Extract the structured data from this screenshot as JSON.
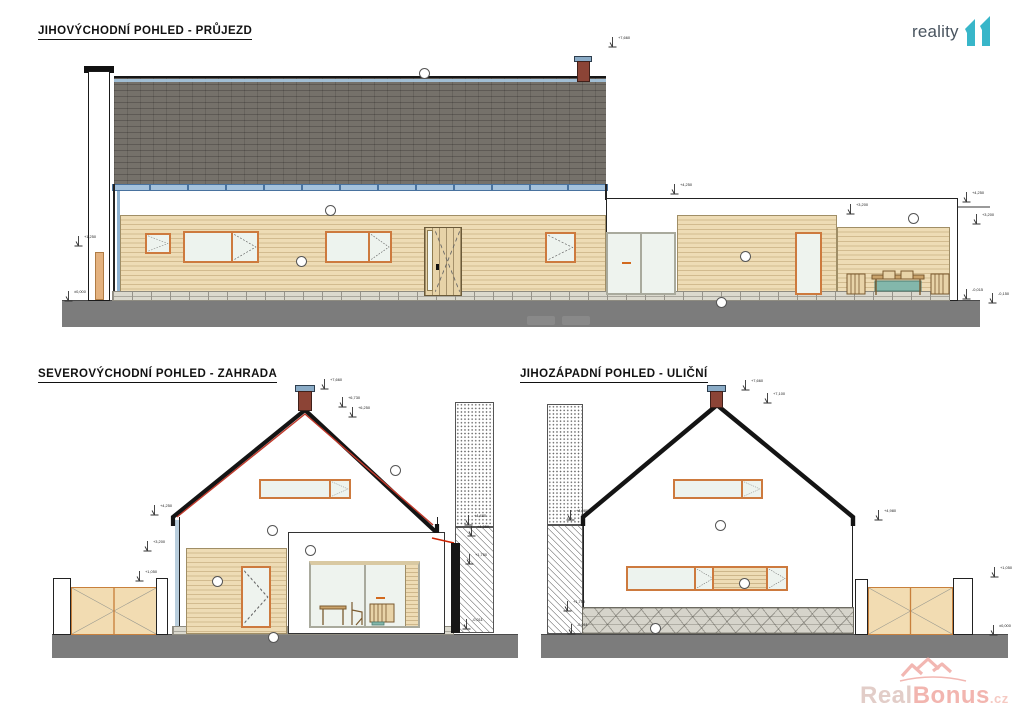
{
  "titles": {
    "southeast": "JIHOVÝCHODNÍ POHLED - PRŮJEZD",
    "northeast": "SEVEROVÝCHODNÍ POHLED - ZAHRADA",
    "southwest": "JIHOZÁPADNÍ POHLED - ULIČNÍ"
  },
  "logo": {
    "word": "reality",
    "number": "11",
    "color": "#38b6c9"
  },
  "watermark": {
    "real": "Real",
    "bonus": "Bonus",
    "tld": ".cz"
  },
  "colors": {
    "roof": "#75716a",
    "gutter": "#a3c1dc",
    "siding": "#eedcb5",
    "window_frame": "#cd7a3e",
    "ground": "#7c7c7c",
    "gate": "#f2dcb2",
    "roof_edge_accent": "#c0392b"
  },
  "level_markers": [
    {
      "x": 608,
      "y": 36,
      "label": "+7,660"
    },
    {
      "x": 670,
      "y": 183,
      "label": "+4,250"
    },
    {
      "x": 846,
      "y": 203,
      "label": "+3,200"
    },
    {
      "x": 962,
      "y": 191,
      "label": "+4,250"
    },
    {
      "x": 972,
      "y": 213,
      "label": "+3,200"
    },
    {
      "x": 74,
      "y": 235,
      "label": "+1,250"
    },
    {
      "x": 64,
      "y": 290,
      "label": "±0,000"
    },
    {
      "x": 962,
      "y": 288,
      "label": "-0,015"
    },
    {
      "x": 988,
      "y": 292,
      "label": "-0,150"
    },
    {
      "x": 320,
      "y": 378,
      "label": "+7,660"
    },
    {
      "x": 338,
      "y": 396,
      "label": "+6,730"
    },
    {
      "x": 348,
      "y": 406,
      "label": "+6,250"
    },
    {
      "x": 150,
      "y": 504,
      "label": "+4,250"
    },
    {
      "x": 143,
      "y": 540,
      "label": "+3,200"
    },
    {
      "x": 135,
      "y": 570,
      "label": "+1,050"
    },
    {
      "x": 464,
      "y": 514,
      "label": "+4,480"
    },
    {
      "x": 467,
      "y": 525,
      "label": "+4,250"
    },
    {
      "x": 465,
      "y": 553,
      "label": "+1,750"
    },
    {
      "x": 462,
      "y": 618,
      "label": "-0,011"
    },
    {
      "x": 741,
      "y": 379,
      "label": "+7,660"
    },
    {
      "x": 763,
      "y": 392,
      "label": "+7,100"
    },
    {
      "x": 566,
      "y": 509,
      "label": "+4,980"
    },
    {
      "x": 874,
      "y": 509,
      "label": "+4,980"
    },
    {
      "x": 990,
      "y": 566,
      "label": "+1,050"
    },
    {
      "x": 989,
      "y": 624,
      "label": "±0,000"
    },
    {
      "x": 563,
      "y": 600,
      "label": "+1,750"
    },
    {
      "x": 567,
      "y": 623,
      "label": "-0,011"
    }
  ],
  "circle_markers": [
    {
      "x": 325,
      "y": 205
    },
    {
      "x": 296,
      "y": 256
    },
    {
      "x": 419,
      "y": 68
    },
    {
      "x": 740,
      "y": 251
    },
    {
      "x": 908,
      "y": 213
    },
    {
      "x": 716,
      "y": 297
    },
    {
      "x": 267,
      "y": 525
    },
    {
      "x": 305,
      "y": 545
    },
    {
      "x": 390,
      "y": 465
    },
    {
      "x": 212,
      "y": 576
    },
    {
      "x": 268,
      "y": 632
    },
    {
      "x": 715,
      "y": 520
    },
    {
      "x": 739,
      "y": 578
    },
    {
      "x": 650,
      "y": 623
    }
  ]
}
